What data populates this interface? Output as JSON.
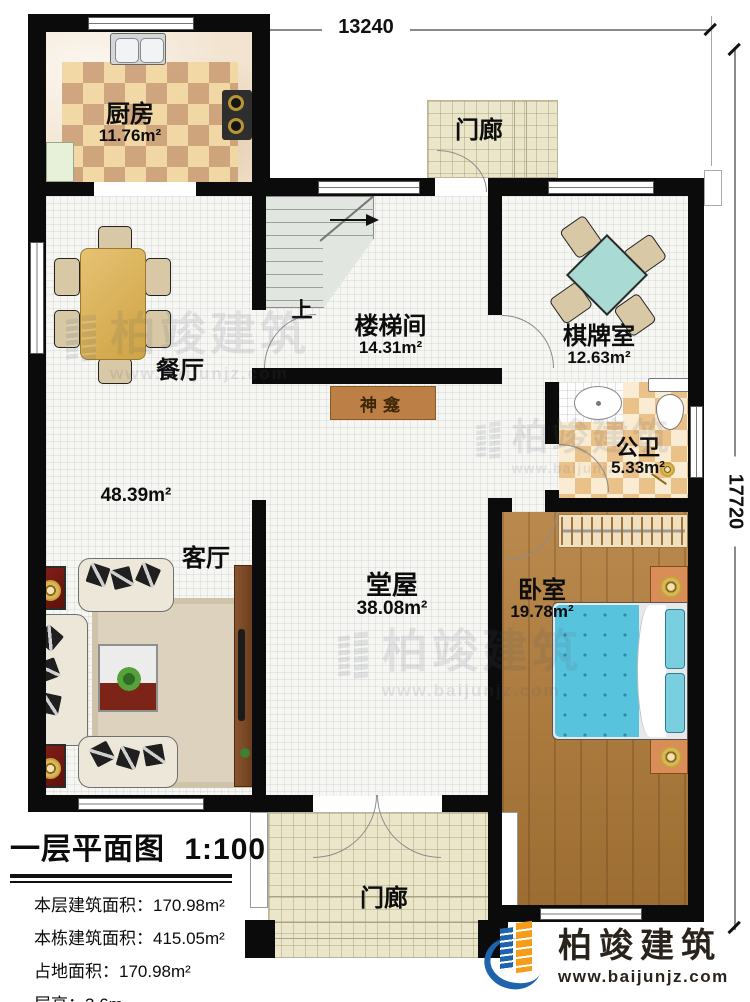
{
  "plan": {
    "dimensions": {
      "top": "13240",
      "right": "17720"
    },
    "rooms": {
      "kitchen": {
        "name": "厨房",
        "area": "11.76m²"
      },
      "porch_top": {
        "name": "门廊"
      },
      "stairwell": {
        "name": "楼梯间",
        "area": "14.31m²"
      },
      "chess": {
        "name": "棋牌室",
        "area": "12.63m²"
      },
      "dining": {
        "name": "餐厅"
      },
      "living": {
        "name": "客厅",
        "area": "48.39m²"
      },
      "bath": {
        "name": "公卫",
        "area": "5.33m²"
      },
      "hall": {
        "name": "堂屋",
        "area": "38.08m²"
      },
      "bedroom": {
        "name": "卧室",
        "area": "19.78m²"
      },
      "porch_bottom": {
        "name": "门廊"
      },
      "shrine": {
        "name": "神龛"
      },
      "stairs_up": "上"
    }
  },
  "title_block": {
    "title": "一层平面图",
    "scale": "1:100",
    "rows": [
      {
        "label": "本层建筑面积：",
        "value": "170.98m²"
      },
      {
        "label": "本栋建筑面积：",
        "value": "415.05m²"
      },
      {
        "label": "占地面积：",
        "value": "170.98m²"
      },
      {
        "label": "层高：",
        "value": "3.6m"
      }
    ]
  },
  "brand": {
    "name": "柏竣建筑",
    "url": "www.baijunjz.com"
  },
  "watermark": {
    "name": "柏竣建筑",
    "url": "www.baijunjz.com"
  },
  "colors": {
    "wall": "#0b0b0b",
    "logo_blue": "#1e63ad",
    "logo_orange": "#f59d1a",
    "bed_blue": "#58c3dd",
    "table_teal": "#a9dbd4"
  }
}
